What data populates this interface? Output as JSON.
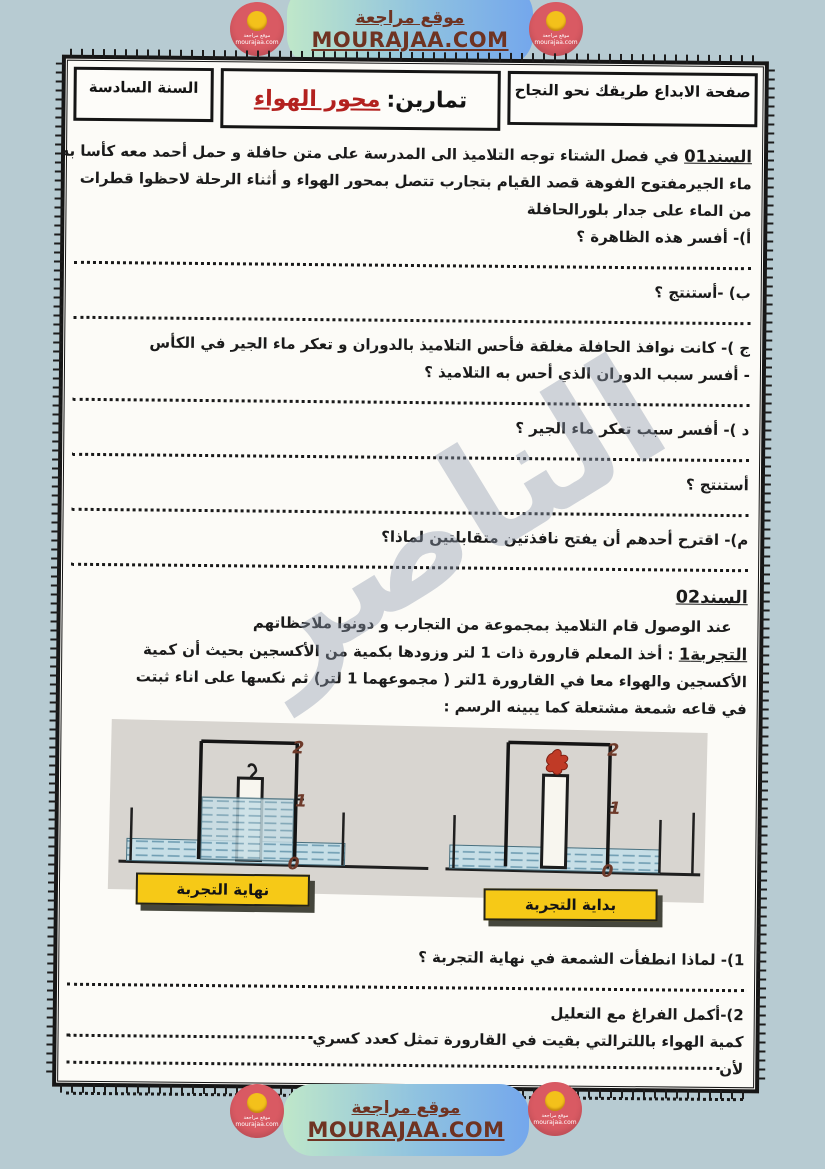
{
  "banner": {
    "site_name": "موقع مراجعة",
    "site_url": "MOURAJAA.COM",
    "logo_title": "موقع مراجعة",
    "logo_url": "mourajaa.com"
  },
  "header": {
    "motto": "صفحة الابداع طريقك نحو النجاح",
    "title_prefix": "تمارين:",
    "title_topic": "محور الهواء",
    "grade": "السنة السادسة"
  },
  "support1": {
    "label": "السند01",
    "intro1": " في فصل الشتاء توجه التلاميذ الى المدرسة على متن حافلة و حمل أحمد معه كأسا به",
    "intro2": "ماء الجيرمفتوح الفوهة قصد القيام بتجارب تتصل بمحور الهواء و أثناء الرحلة لاحظوا قطرات",
    "intro3": "من الماء على جدار بلورالحافلة",
    "qa": "أ)- أفسر هذه الظاهرة ؟",
    "qb": "ب) -أستنتج ؟",
    "qc1": "ج )- كانت نوافذ الحافلة مغلقة فأحس التلاميذ بالدوران و تعكر ماء الجير في الكأس",
    "qc2": "- أفسر سبب الدوران الذي أحس به التلاميذ ؟",
    "qd": "د )- أفسر سبب تعكر ماء الجير ؟",
    "qe": "أستنتج ؟",
    "qf": "م)- اقترح أحدهم أن يفتح نافذتين متقابلتين لماذا؟"
  },
  "support2": {
    "label": "السند02",
    "intro": "عند الوصول قام التلاميذ بمجموعة من التجارب و دونوا ملاحظاتهم",
    "exp_label": "التجربة1",
    "exp_rest1": " : أخذ المعلم قارورة ذات 1 لتر وزودها بكمية من الأكسجين بحيث أن كمية",
    "exp2_a": "الأكسجين والهواء معا في القارورة 1لتر ",
    "exp2_b": "( مجموعهما 1 لتر)",
    "exp2_c": " ثم نكسها على اناء ثبتت",
    "exp3": "في قاعه شمعة مشتعلة كما يبينه الرسم :",
    "q1": "1)- لماذا انطفأت الشمعة في نهاية التجربة ؟",
    "q2": "2)-أكمل الفراغ مع التعليل",
    "q2_stem": "كمية الهواء باللترالتي بقيت في القارورة تمثل كعدد كسري ",
    "q2_because": "لأن "
  },
  "figure": {
    "end_label": "نهاية التجربة",
    "start_label": "بداية التجربة",
    "scale_top": "2",
    "scale_mid": "1",
    "scale_bottom": "0"
  },
  "page_number": "1",
  "watermark": "الناصر",
  "colors": {
    "background": "#b7cbd2",
    "pill_green": "#bfe7c9",
    "pill_blue": "#74a7ec",
    "banner_text": "#6f3322",
    "logo_red": "#d95a63",
    "logo_yellow": "#f3c11b",
    "topic_red": "#b3211f",
    "label_yellow": "#f6c917",
    "figure_bg": "#d8d5d0"
  }
}
